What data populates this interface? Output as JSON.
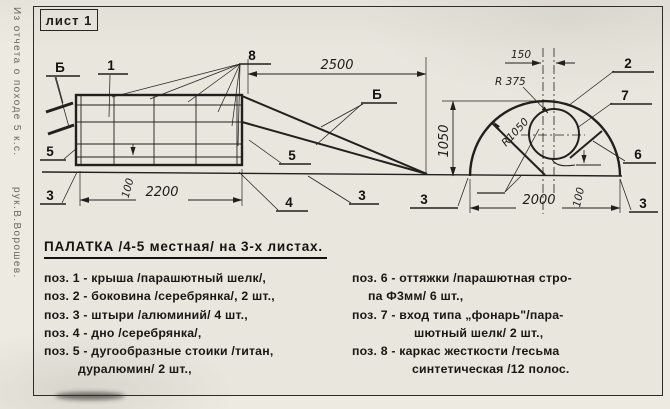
{
  "sheet_label": "лист 1",
  "margin_note": {
    "line1": "Из отчета о походе 5 к.с.",
    "line2": "рук.В.Ворошев."
  },
  "colors": {
    "ink": "#21201d",
    "paper": "#e9e6de"
  },
  "drawing": {
    "dims": {
      "length_total": "2500",
      "length_body": "2200",
      "height": "1050",
      "width": "2000",
      "offset": "150",
      "clearance": "100",
      "radius_small": "R 375",
      "radius_big": "R1050"
    },
    "pos": {
      "p1": "1",
      "p2": "2",
      "p3": "3",
      "p4": "4",
      "p5": "5",
      "p6": "6",
      "p7": "7",
      "p8": "8",
      "view_b": "Б"
    }
  },
  "parts": {
    "title": "ПАЛАТКА /4-5 местная/ на 3-х листах.",
    "left": [
      "поз. 1 - крыша /парашютный шелк/,",
      "поз. 2 - боковина /серебрянка/, 2 шт.,",
      "поз. 3 - штыри /алюминий/ 4 шт.,",
      "поз. 4 - дно /серебрянка/,",
      "поз. 5 - дугообразные стоики /титан,",
      "дуралюмин/ 2 шт.,"
    ],
    "right": [
      "поз. 6 - оттяжки /парашютная стро-",
      "па Ф3мм/ 6 шт.,",
      "поз. 7 - вход типа „фонарь\"/пара-",
      "шютный шелк/ 2 шт.,",
      "поз. 8 - каркас жесткости /тесьма",
      "синтетическая /12 полос."
    ]
  }
}
